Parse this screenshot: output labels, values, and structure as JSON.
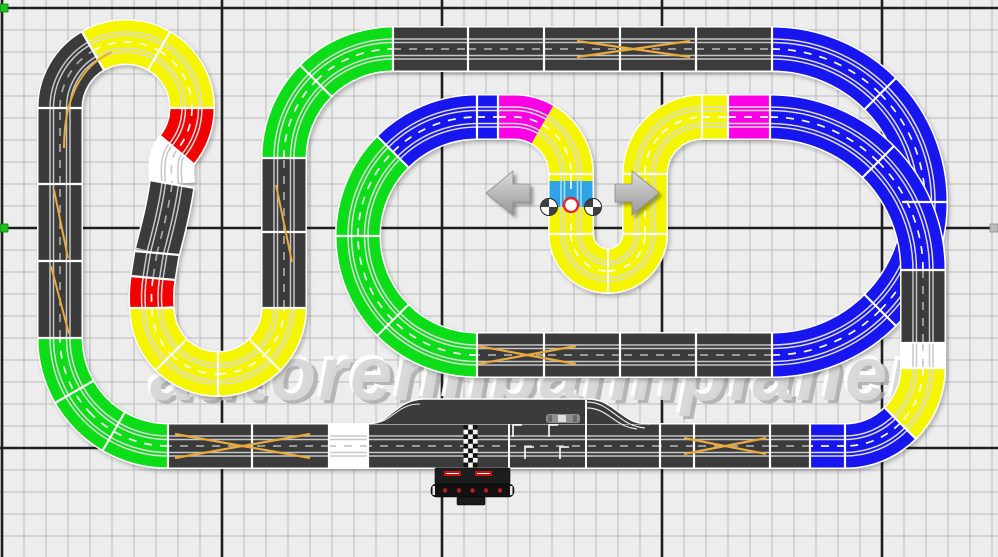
{
  "watermark": {
    "text": "autorennbahnplaner"
  },
  "palette": {
    "canvas_bg": "#ededed",
    "grid_minor": "#bcbcbc",
    "grid_major": "#1e1e1e",
    "asphalt": "#3b3b3b",
    "piece_yellow": "#f5f500",
    "piece_green": "#0ddc18",
    "piece_blue": "#1816ee",
    "piece_red": "#f20000",
    "piece_magenta": "#fb00e4",
    "piece_white": "#ffffff",
    "selected_piece": "#2ea4e6",
    "lane_cross_orange": "#e9a93c",
    "separator_white": "#ffffff",
    "rail_light": "#c9c9c9",
    "rail_on_dark": "#c6c6c6",
    "center_dash_dark": "#a8a8a8",
    "center_dash_light": "#ffffff",
    "arrow_light": "#dcdcdc",
    "arrow_dark": "#989898",
    "handle_fill": "#3f3f3f",
    "selection_marker_red": "#ee2222",
    "edge_handle_green": "#1ec21e",
    "edge_handle_gray": "#bdbdbd",
    "control_unit_black": "#1d1d1d",
    "control_unit_body": "#111111",
    "brand_red": "#cc1111",
    "watermark_fill": "#d8d8d8",
    "watermark_highlight": "#ffffff",
    "watermark_shadow": "#a9a9a9"
  },
  "selection": {
    "handle_count": 2,
    "center_marker": "red-circle"
  },
  "icons": {
    "left_arrow": "left-arrow",
    "right_arrow": "right-arrow"
  }
}
